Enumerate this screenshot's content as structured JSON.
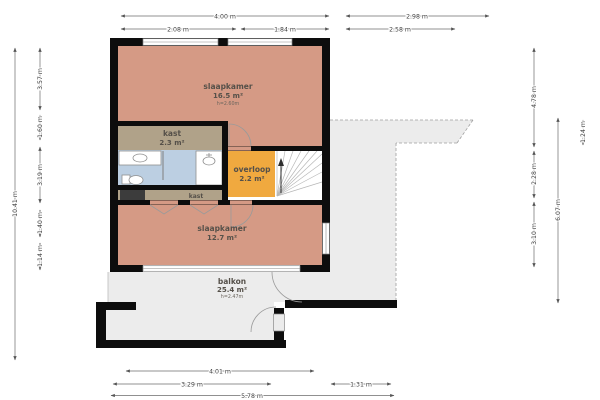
{
  "plan": {
    "title": "first-floor plan",
    "rooms": {
      "bedroom1": {
        "name": "slaapkamer",
        "area": "16.5 m²",
        "ceiling": "h=2.60m"
      },
      "closet1": {
        "name": "kast",
        "area": "2.3 m²"
      },
      "landing": {
        "name": "overloop",
        "area": "2.2 m²"
      },
      "closet2": {
        "name": "kast"
      },
      "bedroom2": {
        "name": "slaapkamer",
        "area": "12.7 m²"
      },
      "balcony": {
        "name": "balkon",
        "area": "25.4 m²",
        "ceiling": "h=2.47m"
      }
    },
    "colors": {
      "bedroom": "#d59a85",
      "closet": "#b0a289",
      "landing": "#f0a93f",
      "bathroom": "#bccfe2",
      "balcony": "#ececec",
      "stairs": "#ffffff",
      "wall": "#0d0d0d",
      "shaft": "#3c3c3c"
    },
    "dims": {
      "top_row1": [
        "4.00 m",
        "2.98 m"
      ],
      "top_row2": [
        "2.08 m",
        "1.84 m",
        "2.58 m"
      ],
      "bottom_row1": [
        "4.01 m"
      ],
      "bottom_row2": [
        "3.29 m",
        "1.31 m"
      ],
      "bottom_row3": [
        "5.78 m"
      ],
      "left_outer": [
        "10.41 m"
      ],
      "left_inner": [
        "3.57 m",
        "1.60 m",
        "3.19 m",
        "1.40 m",
        "1.14 m"
      ],
      "right_col1": [
        "4.78 m",
        "2.28 m",
        "3.10 m"
      ],
      "right_col2": [
        "6.07 m"
      ],
      "right_col3": [
        "1.24 m"
      ]
    }
  }
}
